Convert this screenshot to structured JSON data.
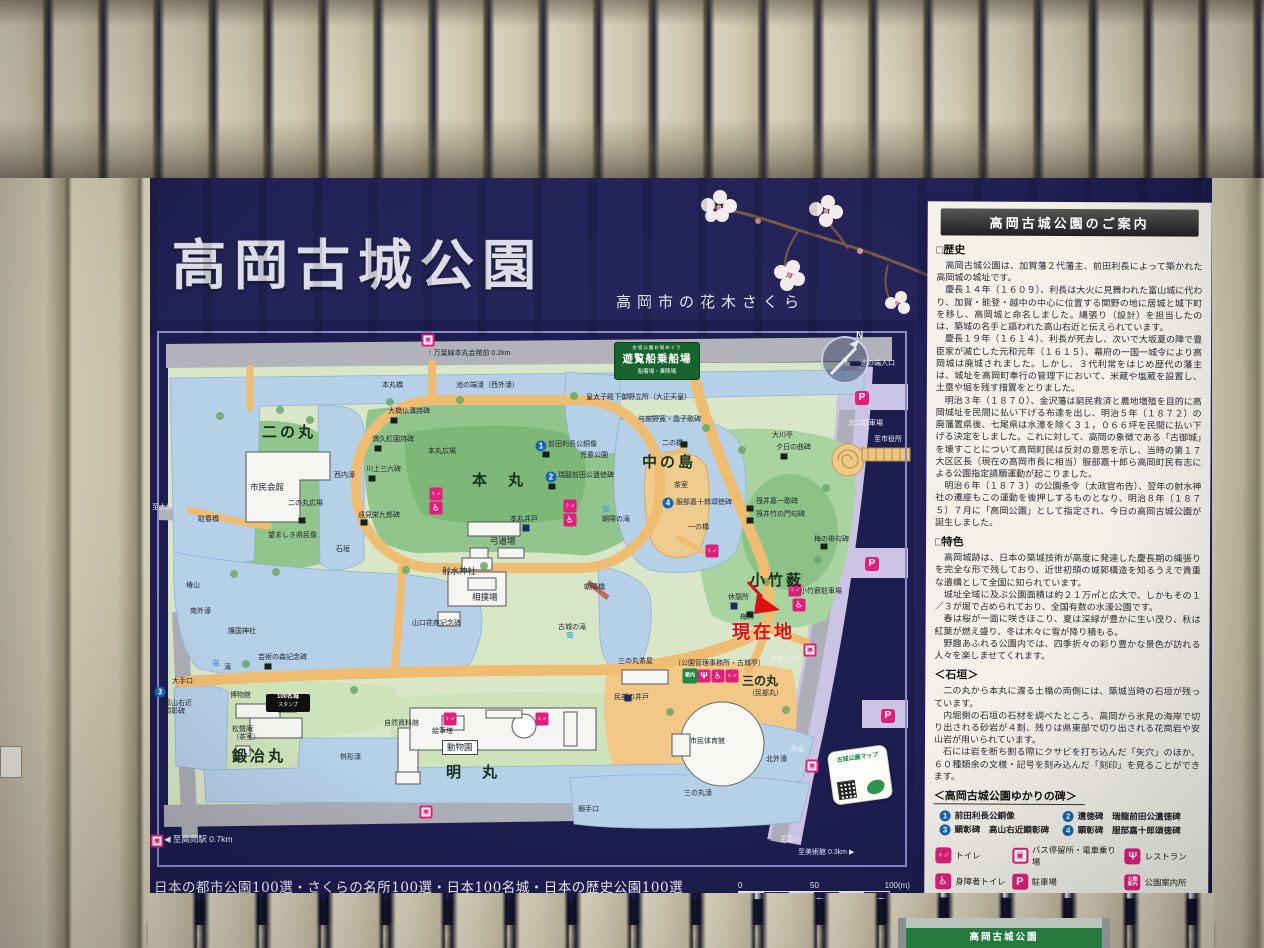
{
  "board": {
    "title": "高岡古城公園",
    "subtitle": "高岡市の花木さくら",
    "awards": "日本の都市公園100選・さくらの名所100選・日本100名城・日本の歴史公園100選",
    "scale": {
      "t0": "0",
      "t50": "50",
      "t100": "100(m)"
    }
  },
  "map": {
    "compass_n": "N",
    "current_location": "現在地",
    "ferry": {
      "line1": "古城公園お堀めぐり",
      "line2": "遊覧船乗船場",
      "line3": "船着場・乗降場"
    },
    "stamp": {
      "l1": "100名城",
      "l2": "スタンプ"
    },
    "qr": "古城公園マップ",
    "labels": [
      {
        "t": "↑ 万葉線本丸会館前 0.2km",
        "x": 278,
        "y": 30,
        "c": "t"
      },
      {
        "t": "本丸橋",
        "x": 232,
        "y": 62,
        "c": "t"
      },
      {
        "t": "池の端濠（西外濠）",
        "x": 306,
        "y": 62,
        "c": "t"
      },
      {
        "t": "池の端入口",
        "x": 710,
        "y": 40,
        "c": "t w"
      },
      {
        "t": "皇太子殿下御野立所（大正天皇）",
        "x": 436,
        "y": 74,
        "c": "t"
      },
      {
        "t": "与謝野寛・晶子歌碑",
        "x": 488,
        "y": 96,
        "c": "t"
      },
      {
        "t": "大川亭",
        "x": 622,
        "y": 112,
        "c": "t"
      },
      {
        "t": "二の橋",
        "x": 512,
        "y": 120,
        "c": "t"
      },
      {
        "t": "夕日の曲碑",
        "x": 626,
        "y": 124,
        "c": "t"
      },
      {
        "t": "北口駐車場",
        "x": 698,
        "y": 100,
        "c": "t w"
      },
      {
        "t": "至市役所",
        "x": 724,
        "y": 116,
        "c": "t w"
      },
      {
        "t": "中の島",
        "x": 492,
        "y": 134,
        "c": "big"
      },
      {
        "t": "茶室",
        "x": 524,
        "y": 162,
        "c": "t"
      },
      {
        "t": "服部嘉十郎頌徳碑",
        "x": 526,
        "y": 179,
        "c": "t"
      },
      {
        "t": "一の橋",
        "x": 538,
        "y": 204,
        "c": "t"
      },
      {
        "t": "筏井嘉一歌碑",
        "x": 606,
        "y": 178,
        "c": "t"
      },
      {
        "t": "筏井竹の門句碑",
        "x": 606,
        "y": 191,
        "c": "t"
      },
      {
        "t": "梅の俳句碑",
        "x": 664,
        "y": 216,
        "c": "t"
      },
      {
        "t": "小竹薮",
        "x": 600,
        "y": 252,
        "c": "big"
      },
      {
        "t": "小竹薮駐車場",
        "x": 650,
        "y": 268,
        "c": "t"
      },
      {
        "t": "休憩所",
        "x": 578,
        "y": 274,
        "c": "t"
      },
      {
        "t": "梅林",
        "x": 590,
        "y": 294,
        "c": "t"
      },
      {
        "t": "現在地",
        "x": 582,
        "y": 302,
        "c": "red"
      },
      {
        "t": "県道入口",
        "x": 620,
        "y": 336,
        "c": "t w"
      },
      {
        "t": "県道",
        "x": 640,
        "y": 426,
        "c": "t w"
      },
      {
        "t": "北外濠",
        "x": 616,
        "y": 436,
        "c": "t"
      },
      {
        "t": "三の丸",
        "x": 592,
        "y": 354,
        "c": "med"
      },
      {
        "t": "（民部丸）",
        "x": 598,
        "y": 370,
        "c": "t"
      },
      {
        "t": "三の丸茶屋",
        "x": 468,
        "y": 338,
        "c": "t"
      },
      {
        "t": "（公園管理事務所・古城亭）",
        "x": 524,
        "y": 340,
        "c": "t"
      },
      {
        "t": "民部の井戸",
        "x": 464,
        "y": 374,
        "c": "t"
      },
      {
        "t": "市民体育館",
        "x": 540,
        "y": 418,
        "c": "t"
      },
      {
        "t": "三の丸濠",
        "x": 534,
        "y": 470,
        "c": "t"
      },
      {
        "t": "搦手口",
        "x": 428,
        "y": 486,
        "c": "t"
      },
      {
        "t": "明　丸",
        "x": 296,
        "y": 444,
        "c": "big"
      },
      {
        "t": "動物園",
        "x": 292,
        "y": 420,
        "c": "s box"
      },
      {
        "t": "絵筆塔",
        "x": 282,
        "y": 408,
        "c": "t"
      },
      {
        "t": "自然資料館",
        "x": 234,
        "y": 400,
        "c": "t"
      },
      {
        "t": "鍛冶丸",
        "x": 82,
        "y": 428,
        "c": "big"
      },
      {
        "t": "松聲庵\n（茶室）",
        "x": 82,
        "y": 406,
        "c": "t"
      },
      {
        "t": "博物館",
        "x": 80,
        "y": 372,
        "c": "t"
      },
      {
        "t": "大手口",
        "x": 22,
        "y": 358,
        "c": "t"
      },
      {
        "t": "高山右近\n顕彰碑",
        "x": 14,
        "y": 380,
        "c": "t"
      },
      {
        "t": "芸術の森記念碑",
        "x": 108,
        "y": 334,
        "c": "t"
      },
      {
        "t": "滝",
        "x": 74,
        "y": 344,
        "c": "t"
      },
      {
        "t": "桝形濠",
        "x": 190,
        "y": 434,
        "c": "t"
      },
      {
        "t": "二の丸",
        "x": 112,
        "y": 104,
        "c": "big"
      },
      {
        "t": "市民会館",
        "x": 100,
        "y": 162,
        "c": "s"
      },
      {
        "t": "二の丸広場",
        "x": 138,
        "y": 180,
        "c": "t"
      },
      {
        "t": "望ましき県民像",
        "x": 118,
        "y": 212,
        "c": "t"
      },
      {
        "t": "西内濠",
        "x": 184,
        "y": 152,
        "c": "t"
      },
      {
        "t": "石垣",
        "x": 186,
        "y": 226,
        "c": "t"
      },
      {
        "t": "駐春橋",
        "x": 48,
        "y": 196,
        "c": "t"
      },
      {
        "t": "至大仏",
        "x": 2,
        "y": 184,
        "c": "t w"
      },
      {
        "t": "椿山",
        "x": 36,
        "y": 262,
        "c": "t"
      },
      {
        "t": "南外濠",
        "x": 40,
        "y": 288,
        "c": "t"
      },
      {
        "t": "護国神社",
        "x": 78,
        "y": 308,
        "c": "t"
      },
      {
        "t": "本　丸",
        "x": 322,
        "y": 152,
        "c": "big"
      },
      {
        "t": "本丸広場",
        "x": 278,
        "y": 128,
        "c": "t"
      },
      {
        "t": "前田利長公銅像",
        "x": 398,
        "y": 121,
        "c": "t"
      },
      {
        "t": "児童公園",
        "x": 430,
        "y": 132,
        "c": "t"
      },
      {
        "t": "瑞龍前田公遺徳碑",
        "x": 408,
        "y": 152,
        "c": "t"
      },
      {
        "t": "本丸井戸",
        "x": 360,
        "y": 196,
        "c": "t"
      },
      {
        "t": "弓道場",
        "x": 340,
        "y": 216,
        "c": "s"
      },
      {
        "t": "射水神社",
        "x": 292,
        "y": 246,
        "c": "s"
      },
      {
        "t": "相撲場",
        "x": 322,
        "y": 272,
        "c": "s"
      },
      {
        "t": "古城の滝",
        "x": 408,
        "y": 304,
        "c": "t"
      },
      {
        "t": "朝陽の滝",
        "x": 452,
        "y": 196,
        "c": "t"
      },
      {
        "t": "朝陽橋",
        "x": 434,
        "y": 264,
        "c": "t"
      },
      {
        "t": "山口花苑記念碑",
        "x": 262,
        "y": 300,
        "c": "t"
      },
      {
        "t": "大橋仏溝詩碑",
        "x": 238,
        "y": 88,
        "c": "t"
      },
      {
        "t": "満久紅園詩碑",
        "x": 222,
        "y": 116,
        "c": "t"
      },
      {
        "t": "川上三六碑",
        "x": 216,
        "y": 146,
        "c": "t"
      },
      {
        "t": "遠見栄九郎碑",
        "x": 208,
        "y": 192,
        "c": "t"
      },
      {
        "t": "◀ 至高岡駅 0.7km",
        "x": 14,
        "y": 514,
        "c": "s w"
      },
      {
        "t": "至富山",
        "x": 630,
        "y": 516,
        "c": "t w"
      },
      {
        "t": "至美術館 0.3km ▶",
        "x": 648,
        "y": 529,
        "c": "t w"
      }
    ],
    "icons": [
      {
        "k": "bus",
        "g": "▣",
        "x": 278,
        "y": 20
      },
      {
        "k": "bus",
        "g": "▣",
        "x": 660,
        "y": 330
      },
      {
        "k": "bus",
        "g": "▣",
        "x": 662,
        "y": 446
      },
      {
        "k": "bus",
        "g": "▣",
        "x": 276,
        "y": 492
      },
      {
        "k": "bus",
        "g": "▣",
        "x": 7,
        "y": 521
      },
      {
        "k": "parking",
        "g": "P",
        "x": 712,
        "y": 78
      },
      {
        "k": "parking",
        "g": "P",
        "x": 722,
        "y": 244
      },
      {
        "k": "parking",
        "g": "P",
        "x": 738,
        "y": 396
      },
      {
        "k": "toilet",
        "g": "♀♂",
        "x": 286,
        "y": 174
      },
      {
        "k": "wheelchair",
        "g": "♿",
        "x": 286,
        "y": 188
      },
      {
        "k": "toilet",
        "g": "♀♂",
        "x": 420,
        "y": 186
      },
      {
        "k": "wheelchair",
        "g": "♿",
        "x": 420,
        "y": 200
      },
      {
        "k": "toilet",
        "g": "♀♂",
        "x": 562,
        "y": 231
      },
      {
        "k": "toilet",
        "g": "♀♂",
        "x": 645,
        "y": 270
      },
      {
        "k": "wheelchair",
        "g": "♿",
        "x": 649,
        "y": 285
      },
      {
        "k": "info",
        "g": "案内",
        "x": 540,
        "y": 356
      },
      {
        "k": "restaurant",
        "g": "Ψ",
        "x": 554,
        "y": 356
      },
      {
        "k": "wheelchair",
        "g": "♿",
        "x": 568,
        "y": 356
      },
      {
        "k": "toilet",
        "g": "♀♂",
        "x": 582,
        "y": 356
      },
      {
        "k": "toilet",
        "g": "♀♂",
        "x": 300,
        "y": 399
      },
      {
        "k": "toilet",
        "g": "♀♂",
        "x": 392,
        "y": 399
      },
      {
        "k": "num",
        "g": "1",
        "x": 391,
        "y": 126
      },
      {
        "k": "num",
        "g": "2",
        "x": 401,
        "y": 157
      },
      {
        "k": "num",
        "g": "3",
        "x": 10,
        "y": 372
      },
      {
        "k": "num",
        "g": "4",
        "x": 518,
        "y": 183
      },
      {
        "k": "sq",
        "x": 244,
        "y": 100
      },
      {
        "k": "sq",
        "x": 228,
        "y": 128
      },
      {
        "k": "sq",
        "x": 222,
        "y": 158
      },
      {
        "k": "sq",
        "x": 214,
        "y": 202
      },
      {
        "k": "sq",
        "x": 152,
        "y": 200
      },
      {
        "k": "sq",
        "x": 396,
        "y": 134
      },
      {
        "k": "sq",
        "x": 402,
        "y": 166
      },
      {
        "k": "sq",
        "x": 534,
        "y": 124
      },
      {
        "k": "sq",
        "x": 634,
        "y": 136
      },
      {
        "k": "sq",
        "x": 600,
        "y": 188
      },
      {
        "k": "sq",
        "x": 600,
        "y": 200
      },
      {
        "k": "sq",
        "x": 674,
        "y": 226
      },
      {
        "k": "sq",
        "x": 118,
        "y": 346
      },
      {
        "k": "sq",
        "x": 600,
        "y": 294
      },
      {
        "k": "bsq",
        "x": 376,
        "y": 208
      },
      {
        "k": "bsq",
        "x": 584,
        "y": 286
      },
      {
        "k": "bsq",
        "x": 478,
        "y": 378
      },
      {
        "k": "falls",
        "g": "≋",
        "x": 66,
        "y": 344
      },
      {
        "k": "falls",
        "g": "≋",
        "x": 456,
        "y": 190
      },
      {
        "k": "falls",
        "g": "≋",
        "x": 420,
        "y": 316
      }
    ]
  },
  "panel": {
    "header": "高岡古城公園のご案内",
    "history": {
      "heading": "□歴史",
      "paragraphs": [
        "高岡古城公園は、加賀藩２代藩主、前田利長によって築かれた高岡城の城址です。",
        "慶長１４年（１６０９）、利長は大火に見舞われた富山城に代わり、加賀・能登・越中の中心に位置する関野の地に居城と城下町を移し、高岡城と命名しました。縄張り（設計）を担当したのは、築城の名手と謳われた高山右近と伝えられています。",
        "慶長１９年（１６１４）、利長が死去し、次いで大坂夏の陣で豊臣家が滅亡した元和元年（１６１５）、幕府の一国一城令により高岡城は廃城されました。しかし、３代利常をはじめ歴代の藩主は、城址を高岡町奉行の管理下において、米蔵や塩蔵を設置し、土塁や堀を残す措置をとりました。",
        "明治３年（１８７０）、金沢藩は窮民救済と農地増殖を目的に高岡城址を民間に払い下げる布達を出し、明治５年（１８７２）の廃藩置県後、七尾県は水濠を除く３１，０６６坪を民間に払い下げる決定をしました。これに対して、高岡の象徴である「古御城」を壊すことについて高岡町民は反対の意思を示し、当時の第１７大区区長（現在の高岡市長に相当）服部嘉十郎ら高岡町民有志による公園指定請願運動が起こりました。",
        "明治６年（１８７３）の公園条令（太政官布告）、翌年の射水神社の遷座もこの運動を後押しするものとなり、明治８年（１８７５）７月に「高岡公園」として指定され、今日の高岡古城公園が誕生しました。"
      ]
    },
    "features": {
      "heading": "□特色",
      "paragraphs": [
        "高岡城跡は、日本の築城技術が高度に発達した慶長期の縄張りを完全な形で残しており、近世初頭の城郭構造を知るうえで貴重な遺構として全国に知られています。",
        "城址全域に及ぶ公園面積は約２１万㎡と広大で、しかもその１／３が堀で占められており、全国有数の水濠公園です。",
        "春は桜が一面に咲きほこり、夏は深緑が豊かに生い茂り、秋は紅葉が燃え盛り、冬は木々に雪が降り積もる。",
        "野趣あふれる公園内では、四季折々の彩り豊かな景色が訪れる人々を楽しませてくれます。"
      ]
    },
    "stonewall": {
      "heading": "＜石垣＞",
      "paragraphs": [
        "二の丸から本丸に渡る土橋の両側には、築城当時の石垣が残っています。",
        "内堀側の石垣の石材を調べたところ、高岡から氷見の海岸で切り出される砂岩が４割、残りは県東部で切り出される花崗岩や安山岩が用いられています。",
        "石には岩を断ち割る際にクサビを打ち込んだ「矢穴」のほか、６０種類余の文様・記号を刻み込んだ「刻印」を見ることができます。"
      ]
    },
    "monuments": {
      "heading": "＜高岡古城公園ゆかりの碑＞",
      "items": [
        {
          "num": "1",
          "label": "前田利長公銅像"
        },
        {
          "num": "2",
          "label": "遺徳碑　瑞龍前田公遺徳碑"
        },
        {
          "num": "3",
          "label": "顕彰碑　高山右近顕彰碑"
        },
        {
          "num": "4",
          "label": "顕彰碑　服部嘉十郎頌徳碑"
        }
      ]
    },
    "legend": [
      {
        "icon": "toilet",
        "glyph": "♀♂",
        "label": "トイレ"
      },
      {
        "icon": "bus",
        "glyph": "▣",
        "label": "バス停留所・電車乗り場"
      },
      {
        "icon": "restaurant",
        "glyph": "Ψ",
        "label": "レストラン"
      },
      {
        "icon": "accessible-toilet",
        "glyph": "♿",
        "label": "身障者トイレ"
      },
      {
        "icon": "parking",
        "glyph": "P",
        "label": "駐車場"
      },
      {
        "icon": "info",
        "glyph": "公園\n案内",
        "label": "公園案内所"
      }
    ]
  },
  "kiosk": {
    "title": "高岡古城公園"
  }
}
